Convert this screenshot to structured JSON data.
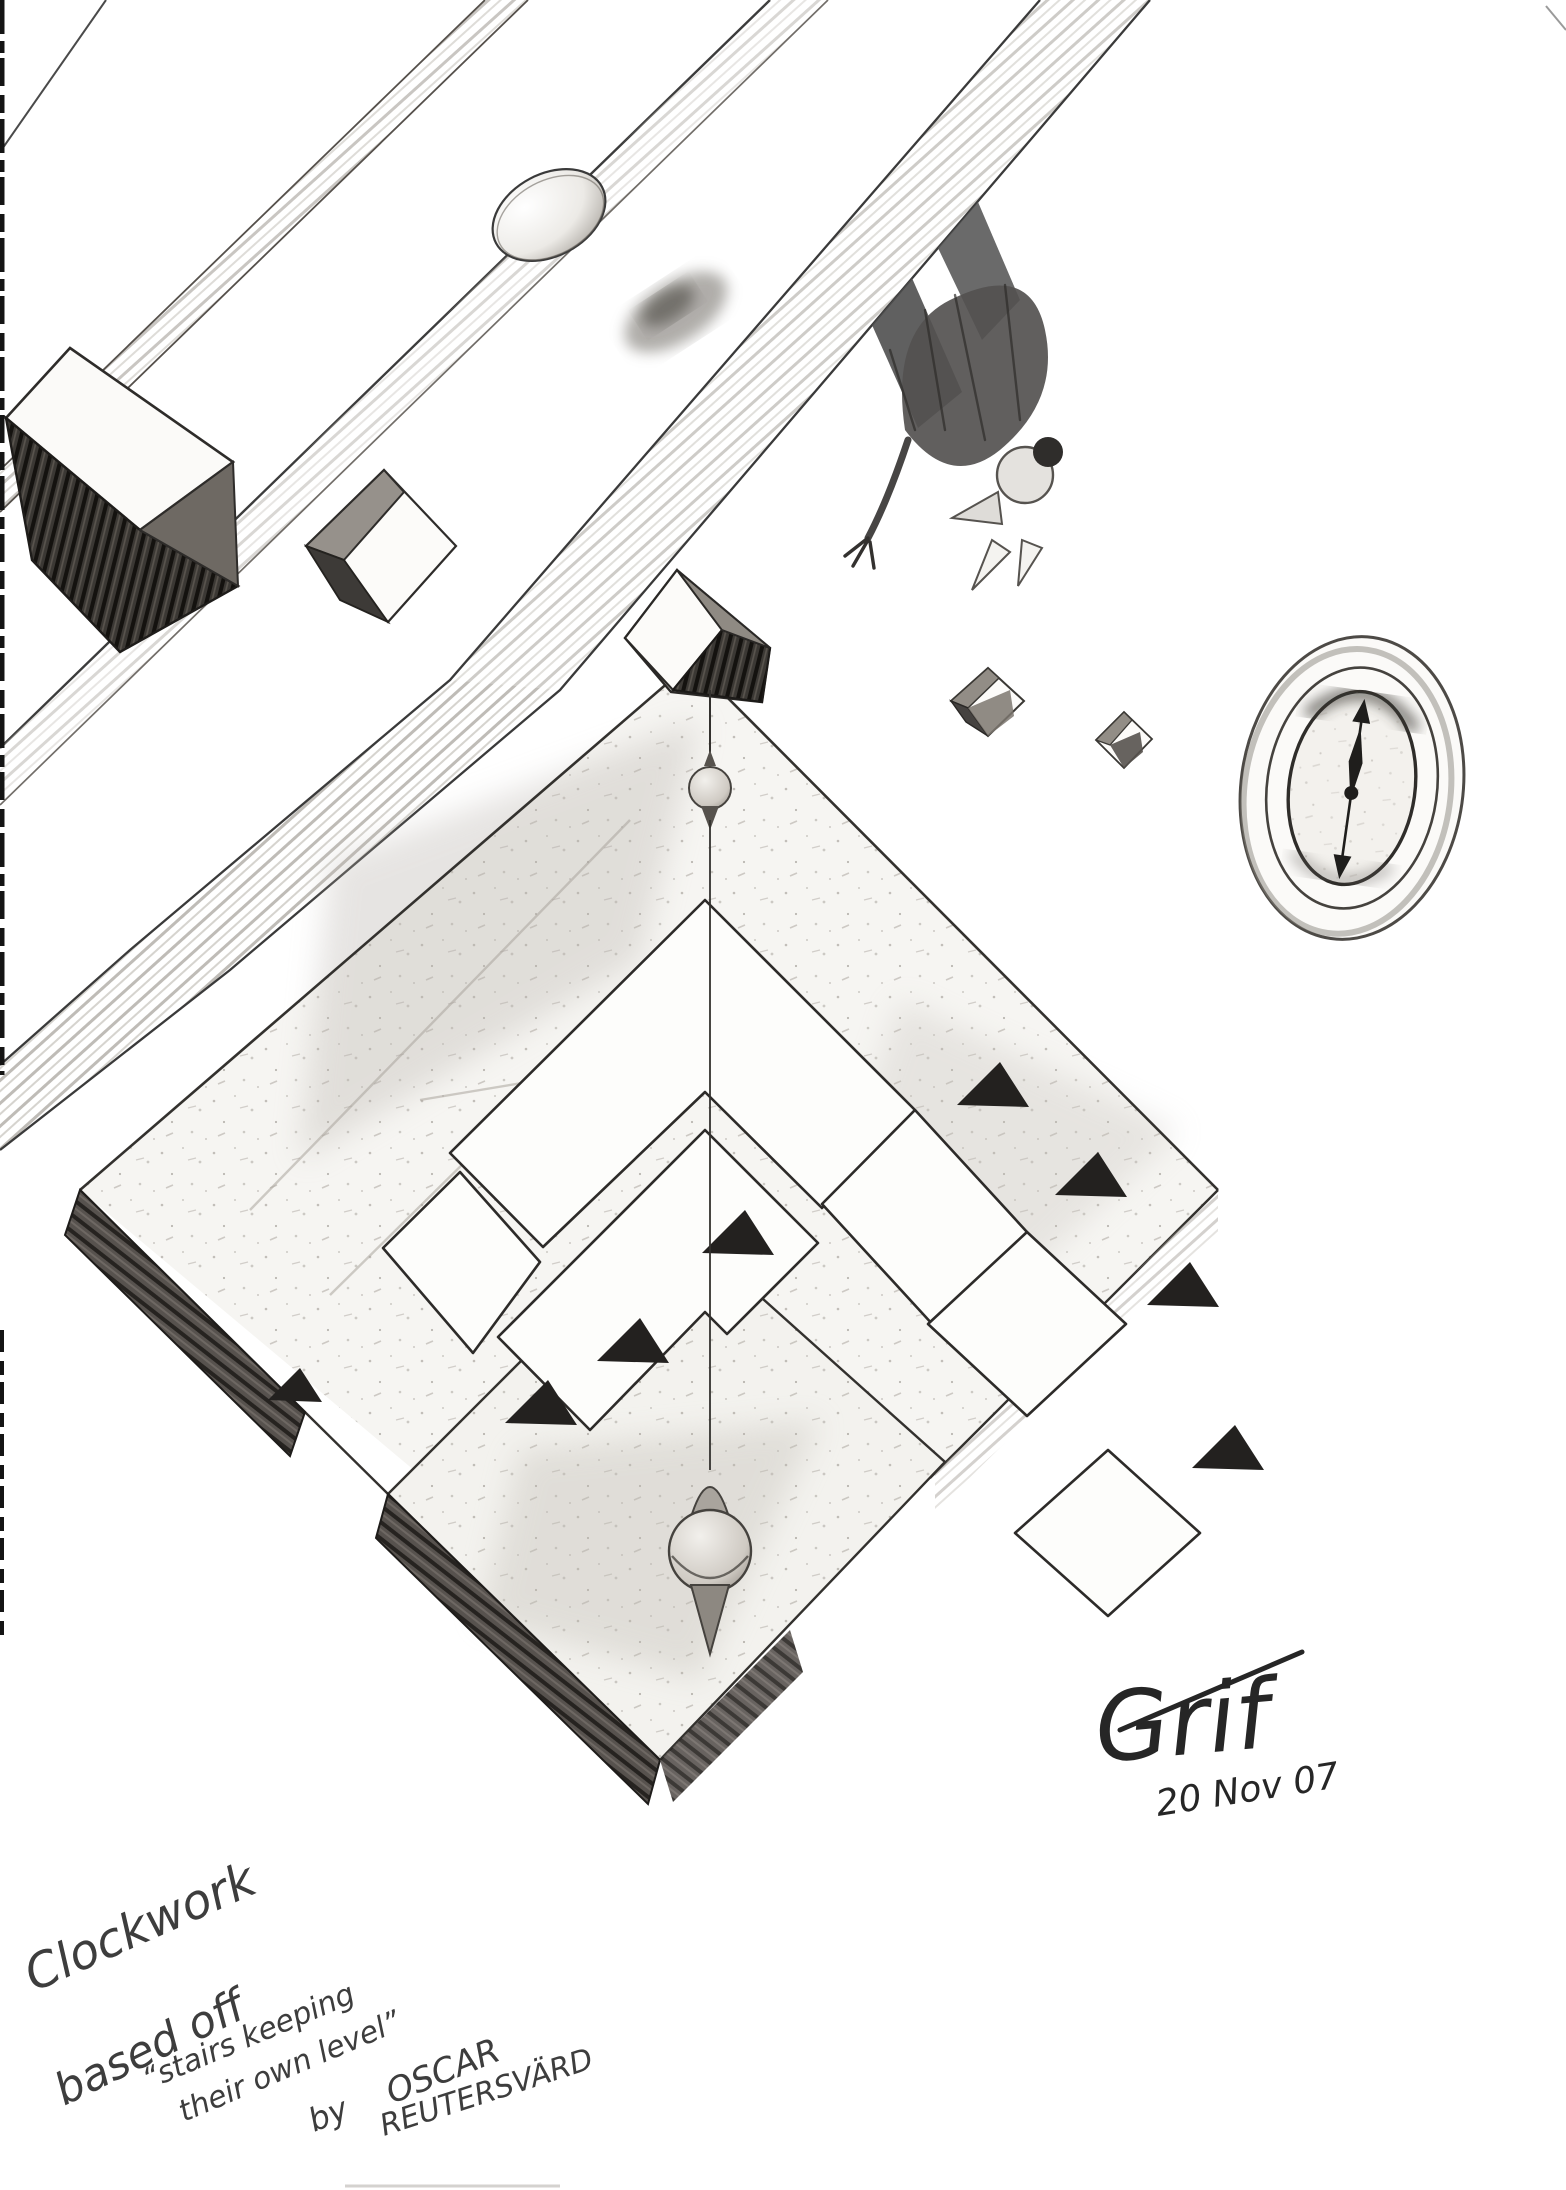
{
  "artwork": {
    "title": "Clockwork",
    "caption_intro": "based off",
    "quote_line1": "“stairs keeping",
    "quote_line2": "their own level”",
    "byword": "by",
    "artist_first": "OSCAR",
    "artist_last": "REUTERSVÄRD",
    "signature": "Grif",
    "date": "20 Nov 07"
  },
  "palette": {
    "paper": "#ffffff",
    "pencil_dark": "#2e2e2e",
    "pencil_mid": "#6f6a64",
    "pencil_light": "#b5b0aa",
    "slab_dark": "#3f3b38"
  }
}
